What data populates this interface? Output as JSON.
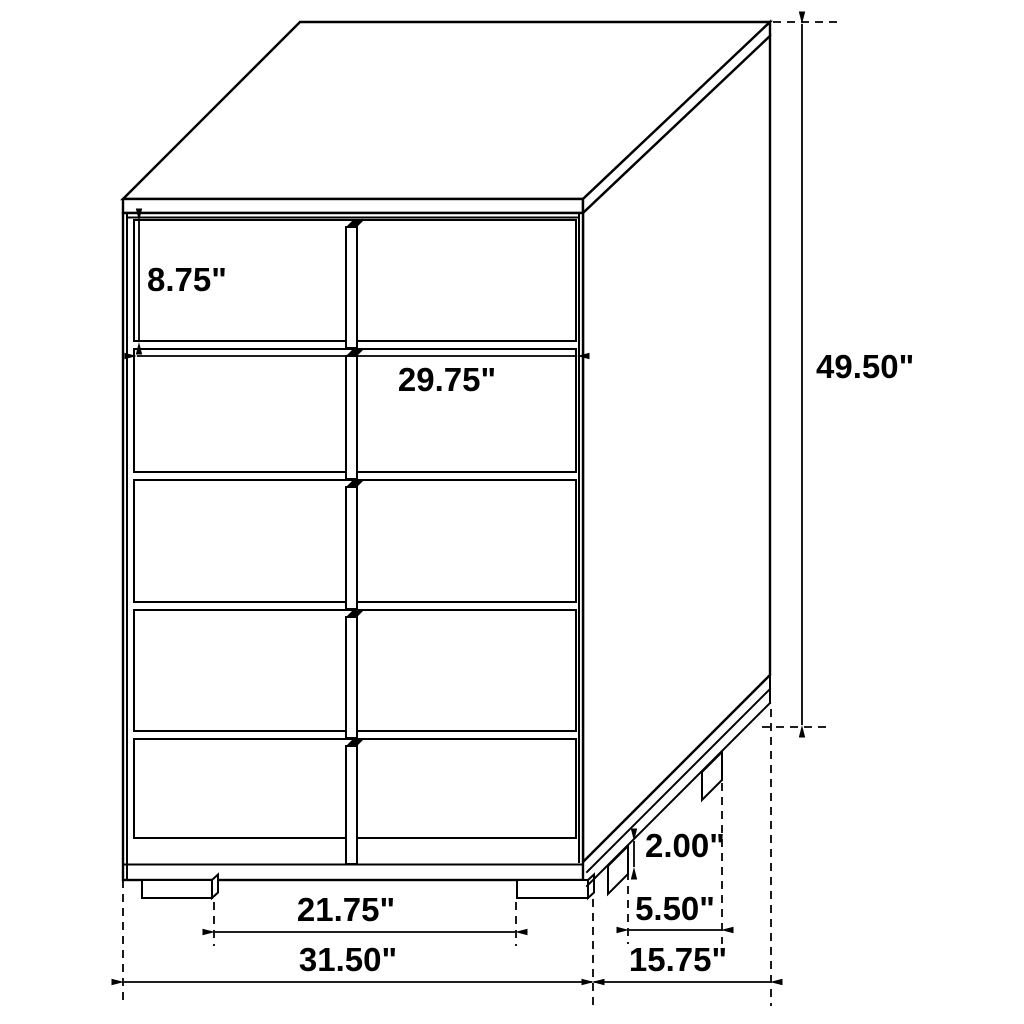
{
  "diagram": {
    "type": "furniture-dimension-drawing",
    "drawer_count": 5,
    "colors": {
      "background": "#ffffff",
      "line": "#000000"
    },
    "dimensions": {
      "drawer_height": "8.75\"",
      "drawer_width": "29.75\"",
      "overall_height": "49.50\"",
      "leg_height": "2.00\"",
      "side_leg_spacing": "5.50\"",
      "depth": "15.75\"",
      "front_leg_spacing": "21.75\"",
      "overall_width": "31.50\""
    }
  }
}
